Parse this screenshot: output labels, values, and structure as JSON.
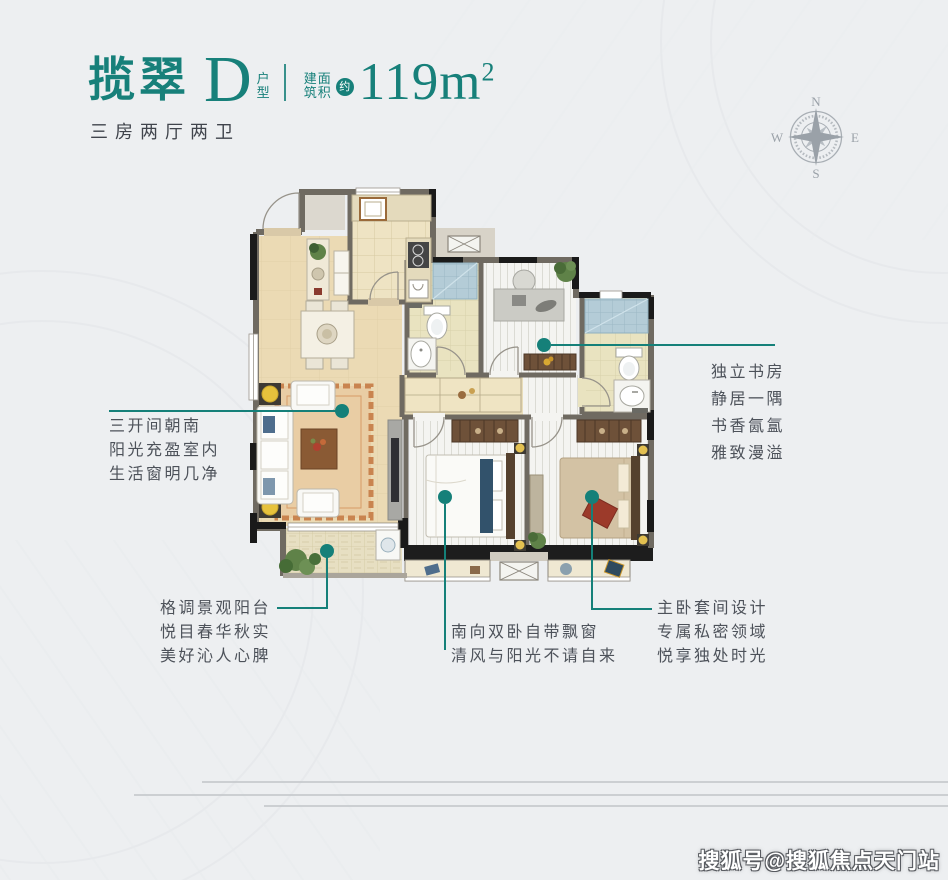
{
  "header": {
    "project_name": "揽翠",
    "unit_type": "D",
    "unit_label_top": "户",
    "unit_label_bottom": "型",
    "area_label_top": "建面",
    "area_label_bottom": "筑积",
    "approx": "约",
    "area_value": "119m",
    "area_exponent": "2",
    "subtitle": "三房两厅两卫"
  },
  "compass": {
    "north": "N",
    "south": "S",
    "east": "E",
    "west": "W"
  },
  "annotations": {
    "living": {
      "lines": [
        "三开间朝南",
        "阳光充盈室内",
        "生活窗明几净"
      ]
    },
    "study": {
      "lines": [
        "独立书房",
        "静居一隅",
        "书香氤氲",
        "雅致漫溢"
      ]
    },
    "balcony": {
      "lines": [
        "格调景观阳台",
        "悦目春华秋实",
        "美好沁人心脾"
      ]
    },
    "south_bedrooms": {
      "lines": [
        "南向双卧自带飘窗",
        "清风与阳光不请自来"
      ]
    },
    "master": {
      "lines": [
        "主卧套间设计",
        "专属私密领域",
        "悦享独处时光"
      ]
    }
  },
  "watermark": "搜狐号@搜狐焦点天门站",
  "colors": {
    "accent": "#17807a",
    "text": "#4d525a",
    "compass": "#9aa1a8",
    "wall": "#6f6a61"
  }
}
